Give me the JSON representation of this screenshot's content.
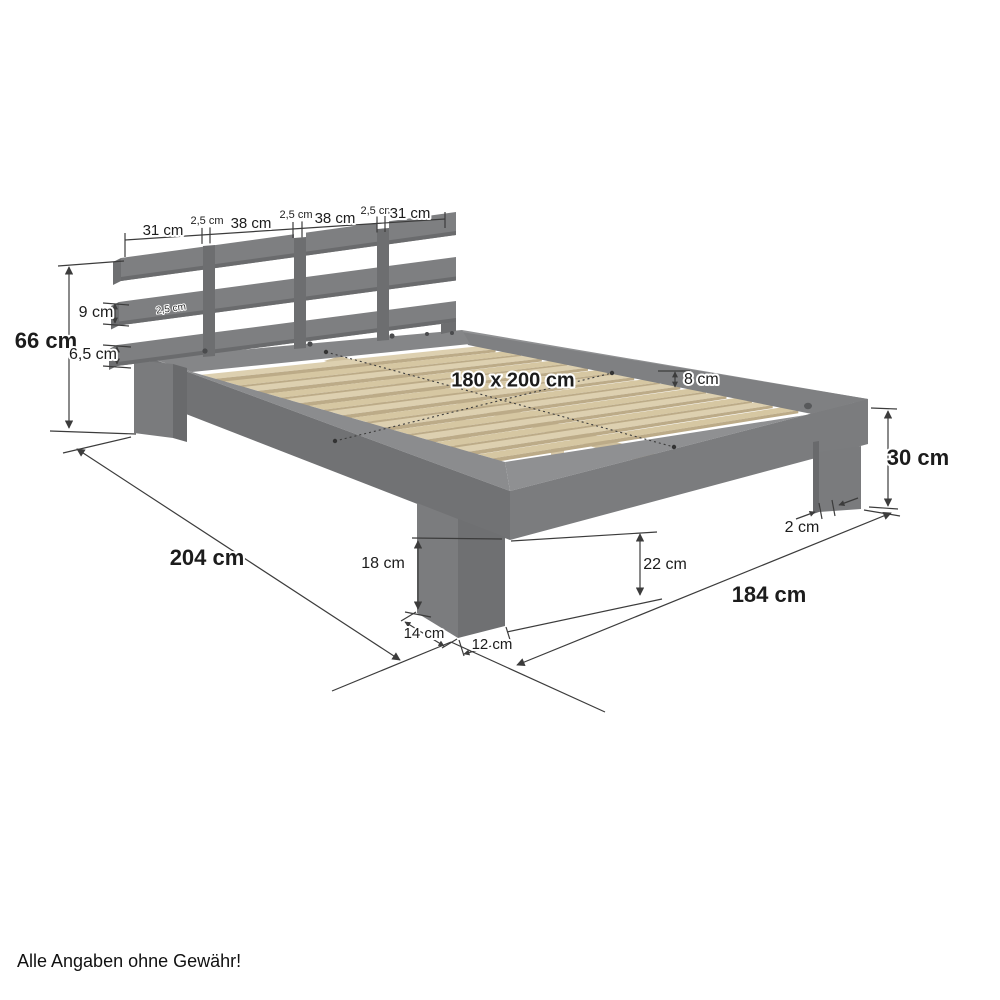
{
  "diagram": {
    "subject": "wooden double bed frame with slatted base and headboard, isometric dimension drawing"
  },
  "dimensions": {
    "headboard_segments": [
      "31 cm",
      "2,5 cm",
      "38 cm",
      "2,5 cm",
      "38 cm",
      "2,5 cm",
      "31 cm"
    ],
    "headboard_height": "66 cm",
    "headboard_slat_height": "9 cm",
    "headboard_slat_gap": "2,5 cm",
    "headboard_bottom_slat_height": "6,5 cm",
    "lying_surface": "180 x 200 cm",
    "side_rail_height": "8 cm",
    "foot_end_height": "30 cm",
    "leg_corner_offset": "2 cm",
    "total_length": "204 cm",
    "front_leg_height": "18 cm",
    "underbed_clearance": "22 cm",
    "leg_depth": "14 cm",
    "leg_width": "12 cm",
    "total_width": "184 cm"
  },
  "footer": {
    "disclaimer": "Alle Angaben ohne Gewähr!"
  },
  "colors": {
    "frame_gray": "#7e7f81",
    "slat_wood": "#ddd0b0",
    "dimension_line": "#3c3c3c",
    "background": "#ffffff"
  }
}
